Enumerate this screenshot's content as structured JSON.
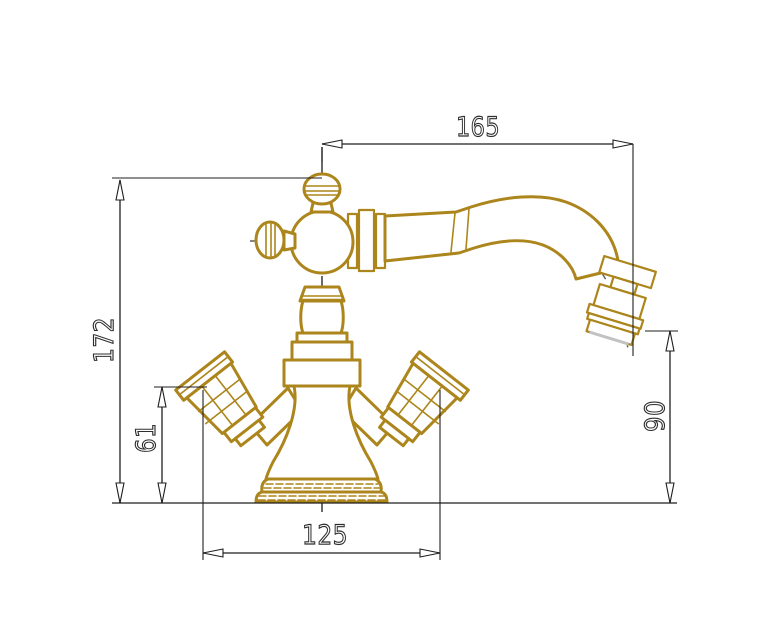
{
  "drawing": {
    "subject": "classic-two-handle-basin-mixer-faucet-technical-drawing",
    "view": "side-elevation",
    "units": "mm",
    "colors": {
      "brass_outline": "#AC861C",
      "dimension_line": "#1F1F1F",
      "centerline": "#5D5D5D",
      "background": "#FFFFFF",
      "outlet_face": "#C2C2C2"
    },
    "dimensions": {
      "spout_reach": {
        "label": "165",
        "orientation": "horizontal",
        "position": "top",
        "measures": "spout projection from body axis to outlet"
      },
      "total_height": {
        "label": "172",
        "orientation": "vertical",
        "position": "left",
        "measures": "overall height from base to top knob"
      },
      "handle_height": {
        "label": "61",
        "orientation": "vertical",
        "position": "left-inner",
        "measures": "height from base to handle top"
      },
      "outlet_height": {
        "label": "90",
        "orientation": "vertical",
        "position": "right",
        "measures": "height from base to spout outlet"
      },
      "handle_span": {
        "label": "125",
        "orientation": "horizontal",
        "position": "bottom",
        "measures": "overall width across handles"
      }
    },
    "parts": [
      "top-screw-knob",
      "side-screw-knob",
      "valve-body-sphere",
      "spout-connection-rings",
      "swan-neck-spout",
      "aerator-outlet-tip",
      "column-stack",
      "left-cross-handle",
      "right-cross-handle",
      "base-plinth"
    ]
  }
}
